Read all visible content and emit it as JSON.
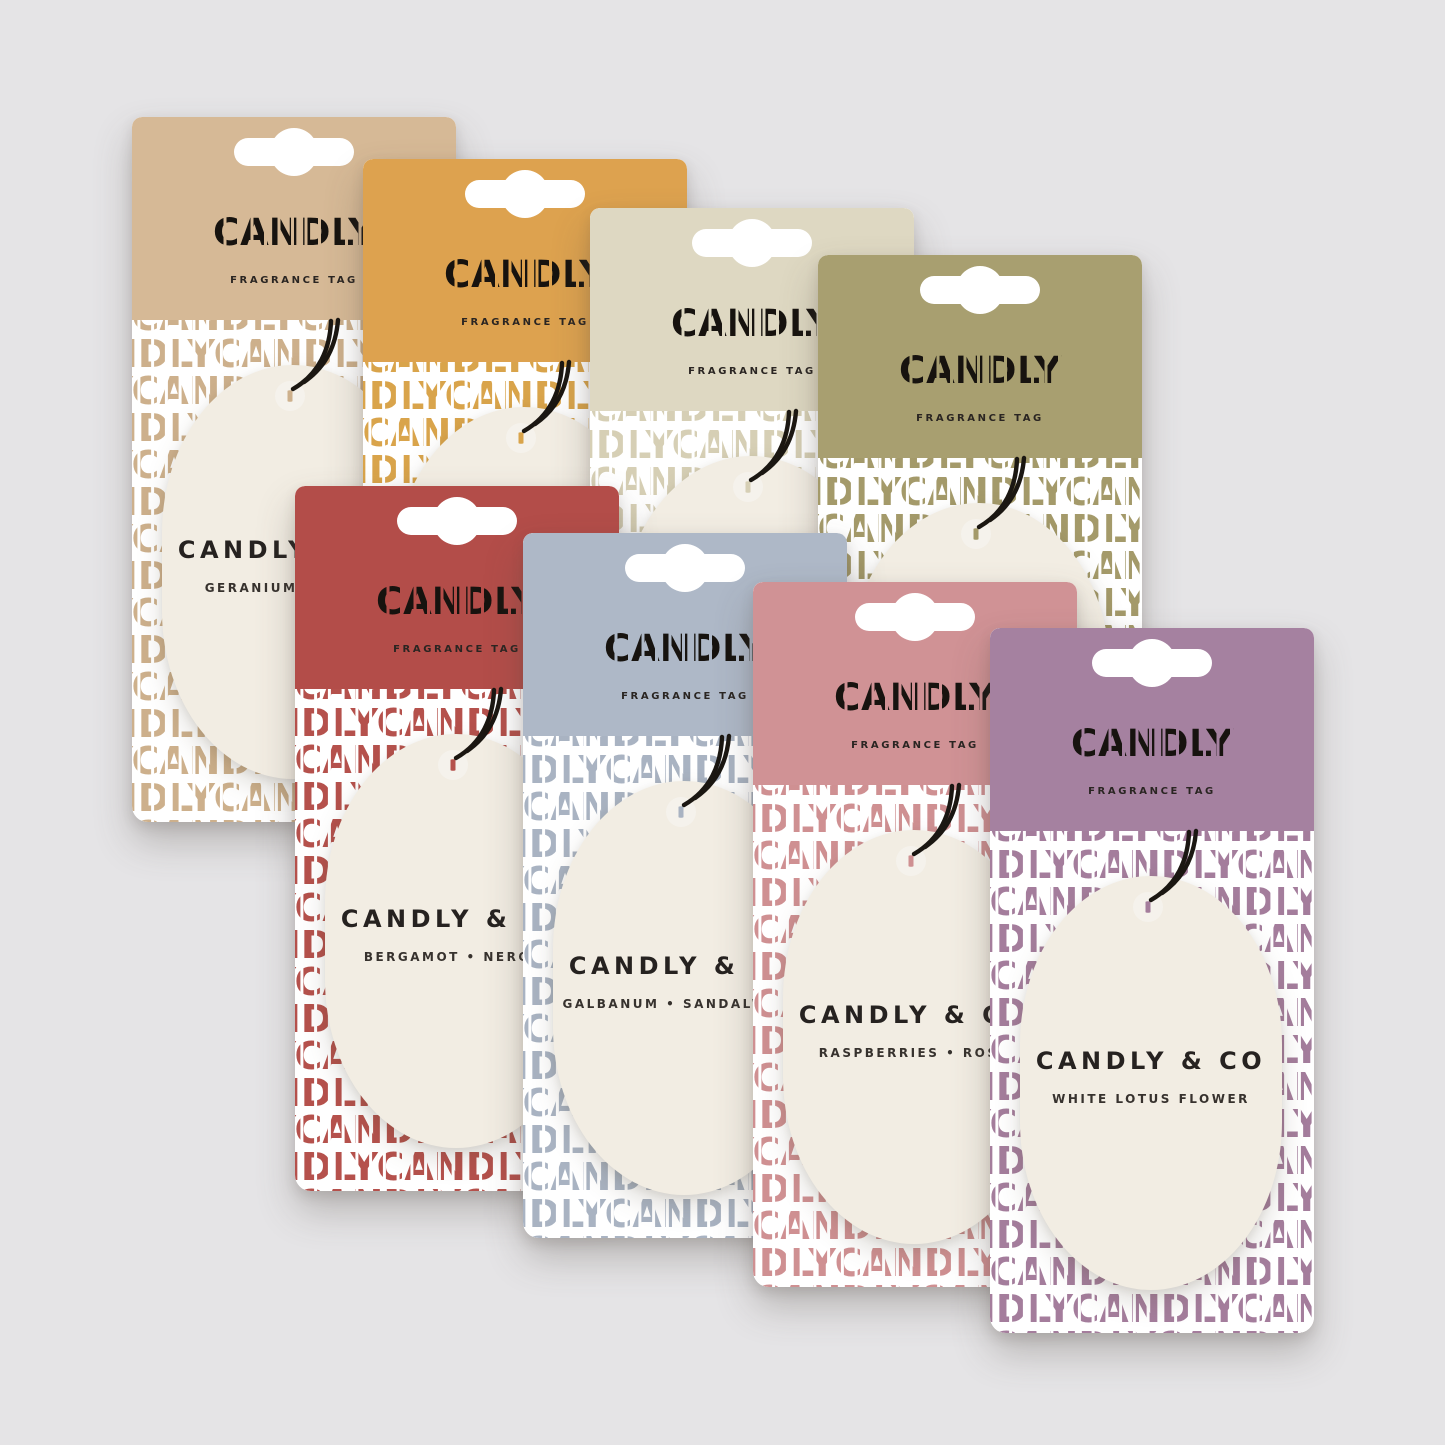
{
  "background_color": "#e5e4e6",
  "brand": {
    "logo": "CANDLY",
    "header_label": "FRAGRANCE TAG",
    "tag_brand": "CANDLY & CO",
    "pattern_row": "CANDLYCANDLYCANDLY"
  },
  "tag": {
    "bg_color": "#f2ede3",
    "string_color": "#1b1712"
  },
  "cards": [
    {
      "id": "tan",
      "header_color": "#d6b996",
      "pattern_color": "#cdb08c",
      "tag_title": "CANDLY & CO",
      "tag_subtitle": "GERANIUM • AMBER"
    },
    {
      "id": "mustard",
      "header_color": "#dda24f",
      "pattern_color": "#d9a44b",
      "tag_title": "CANDLY & CO",
      "tag_subtitle": ""
    },
    {
      "id": "cream",
      "header_color": "#ded8c2",
      "pattern_color": "#d6cfb5",
      "tag_title": "CANDLY & CO",
      "tag_subtitle": ""
    },
    {
      "id": "olive",
      "header_color": "#a89f70",
      "pattern_color": "#a49a6a",
      "tag_title": "CANDLY & CO",
      "tag_subtitle": ""
    },
    {
      "id": "red",
      "header_color": "#b34d49",
      "pattern_color": "#b5514c",
      "tag_title": "CANDLY & CO",
      "tag_subtitle": "BERGAMOT • NEROLI"
    },
    {
      "id": "blue-grey",
      "header_color": "#aeb8c7",
      "pattern_color": "#a9b3c2",
      "tag_title": "CANDLY & CO",
      "tag_subtitle": "GALBANUM • SANDALWOOD"
    },
    {
      "id": "pink",
      "header_color": "#d09295",
      "pattern_color": "#cf9092",
      "tag_title": "CANDLY & CO",
      "tag_subtitle": "RASPBERRIES • ROSE"
    },
    {
      "id": "purple",
      "header_color": "#a581a0",
      "pattern_color": "#a47d9c",
      "tag_title": "CANDLY & CO",
      "tag_subtitle": "WHITE LOTUS FLOWER"
    }
  ]
}
